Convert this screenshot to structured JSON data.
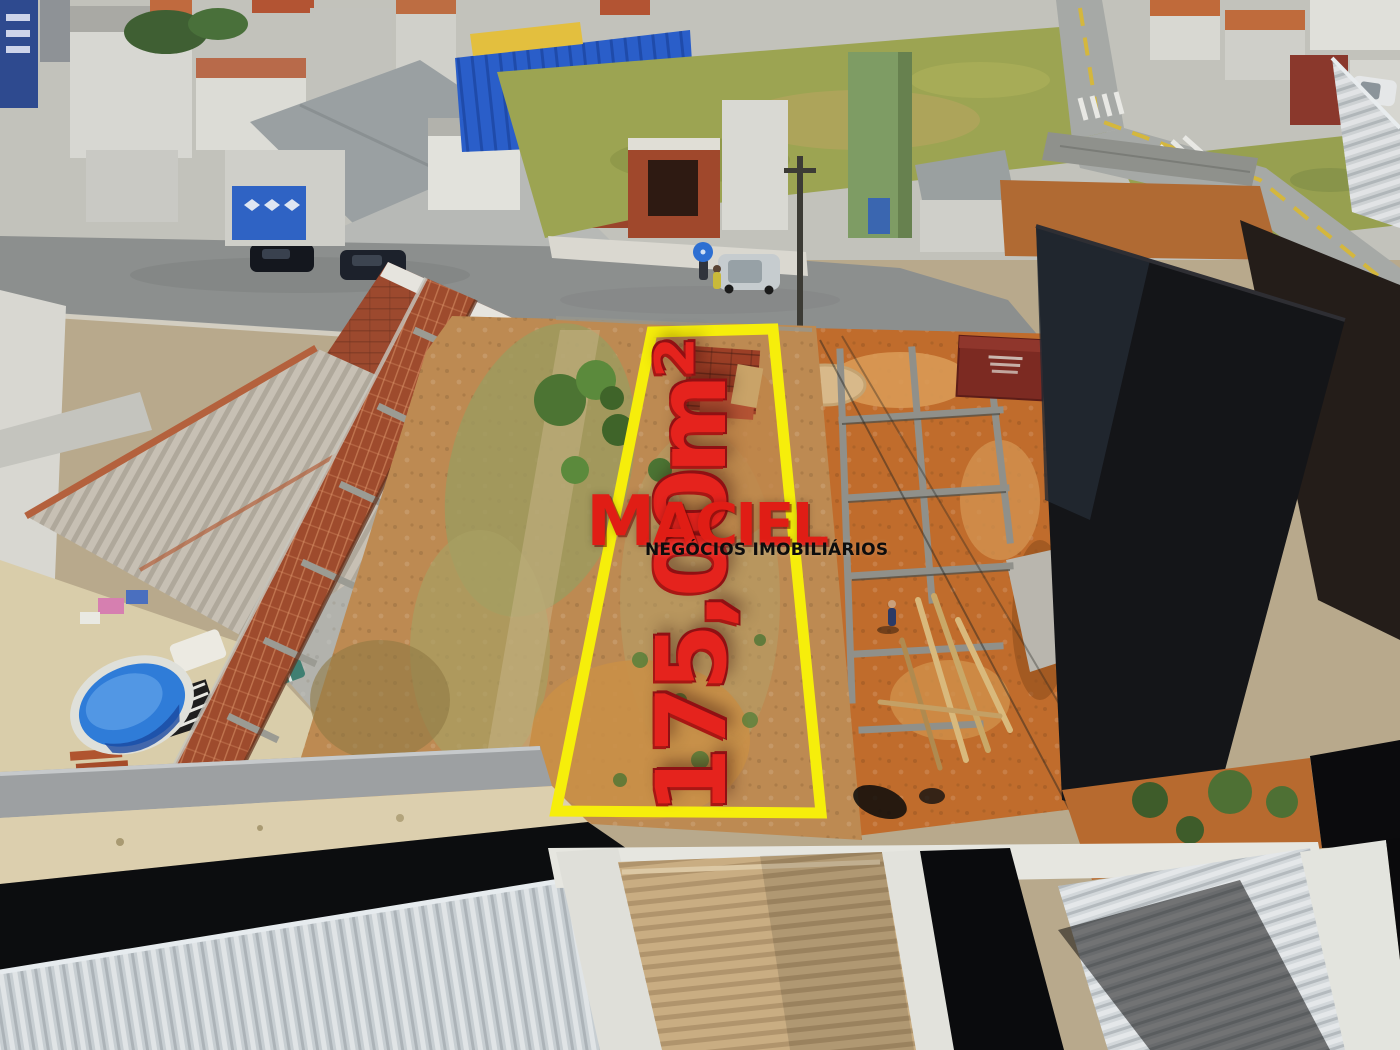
{
  "watermark": {
    "brand": "MACIEL",
    "tagline": "NEGÓCIOS IMOBILIÁRIOS"
  },
  "overlay": {
    "area_label": "175,00m²"
  },
  "colors": {
    "outline_yellow": "#f6ee0b",
    "area_text": "#e5231d",
    "brand_red": "#e01d15",
    "tagline": "#0d0d0d"
  }
}
